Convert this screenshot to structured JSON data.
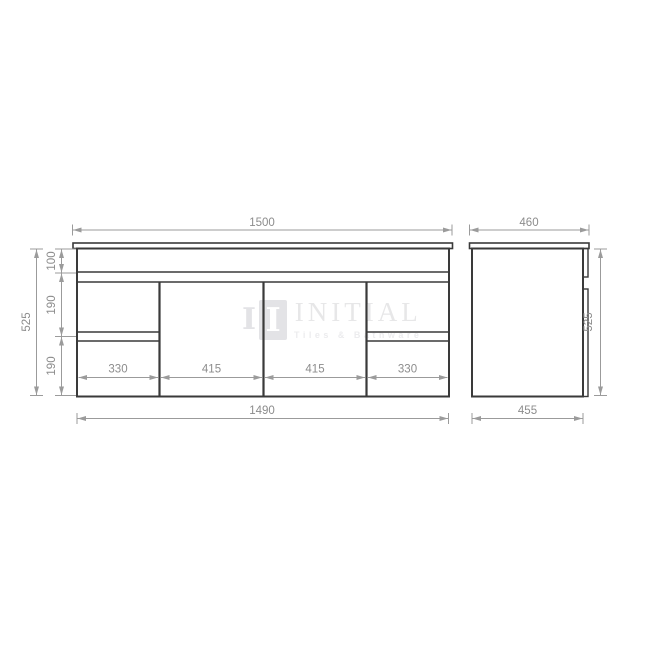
{
  "watermark": {
    "brand": "INITIAL",
    "tagline": "Tiles & Bathware",
    "logo_letter": "I",
    "logo_bar_letter": "I"
  },
  "front_view": {
    "dimensions": {
      "top_width": "1500",
      "bottom_width": "1490",
      "overall_height": "525",
      "section_top": "100",
      "section_middle": "190",
      "section_bottom": "190",
      "drawer_left_width": "330",
      "door_left_width": "415",
      "door_right_width": "415",
      "drawer_right_width": "330"
    }
  },
  "side_view": {
    "dimensions": {
      "top_depth": "460",
      "bottom_depth": "455",
      "overall_height": "525"
    }
  },
  "colors": {
    "outline": "#3a3a3a",
    "dimension_line": "#9b9b9b",
    "dimension_text": "#8c8c8c",
    "watermark_text": "#e7e7e8",
    "watermark_logo": "#e3e3e6"
  }
}
